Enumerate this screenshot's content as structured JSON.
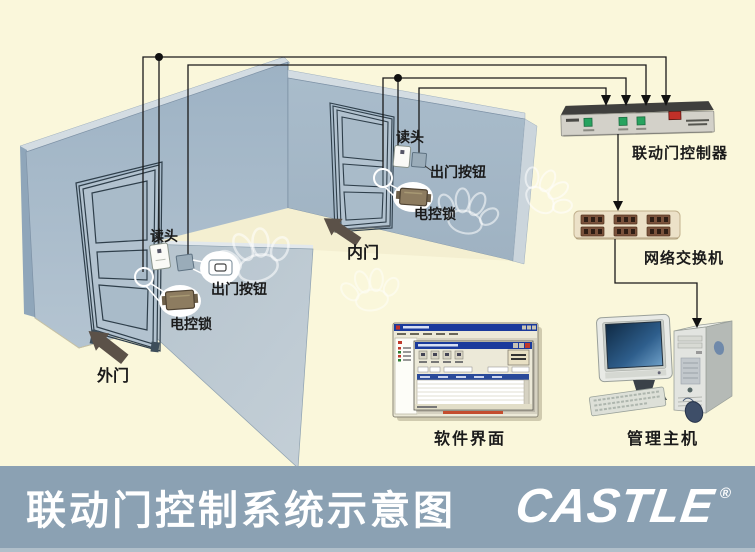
{
  "meta": {
    "width": 755,
    "height": 552,
    "kind": "interlocking-door access control system schematic"
  },
  "title_bar": {
    "title": "联动门控制系统示意图",
    "logo_text": "CASTLE",
    "registered_mark": "®",
    "background": "#8BA1B3",
    "text_color": "#FFFFFF"
  },
  "diagram": {
    "background": "#FAF7DB",
    "outer_door": {
      "door_label": "外门",
      "reader_label": "读头",
      "exit_button_label": "出门按钮",
      "lock_label": "电控锁"
    },
    "inner_door": {
      "door_label": "内门",
      "reader_label": "读头",
      "exit_button_label": "出门按钮",
      "lock_label": "电控锁"
    },
    "controller": {
      "label": "联动门控制器",
      "led_color": "#27A35F",
      "power_switch_color": "#C03028"
    },
    "network_switch": {
      "label": "网络交换机",
      "body_color": "#ECE1C8",
      "port_color": "#7A523C"
    },
    "software": {
      "label": "软件界面"
    },
    "host": {
      "label": "管理主机"
    },
    "colors": {
      "wall": "#A7BACA",
      "partition": "#B8C6D0",
      "floor": "#F4EFD1",
      "wire": "#1A1A1A",
      "door_arrow": "#5B5148",
      "lock_body": "#8D7C60",
      "screen": "#16324F"
    }
  }
}
